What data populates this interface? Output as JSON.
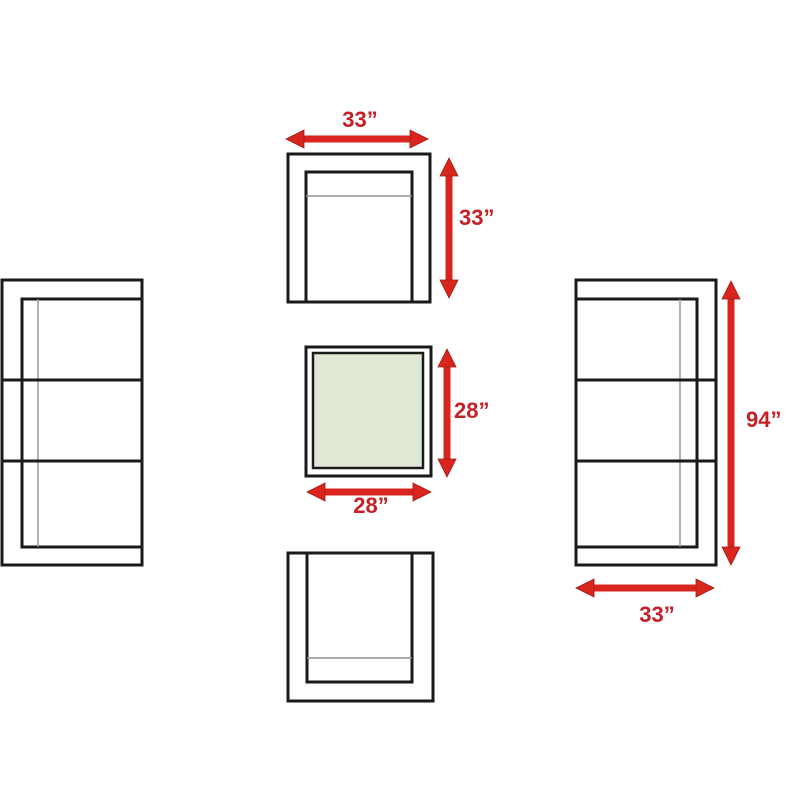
{
  "diagram": {
    "name": "patio-furniture-set-dimensions",
    "pieces": [
      {
        "id": "armchair-top",
        "kind": "armchair",
        "width_label": "33”",
        "depth_label": "33”"
      },
      {
        "id": "coffee-table",
        "kind": "square-table",
        "width_label": "28”",
        "depth_label": "28”"
      },
      {
        "id": "armchair-bottom",
        "kind": "armchair"
      },
      {
        "id": "sofa-left",
        "kind": "three-seat-sofa"
      },
      {
        "id": "sofa-right",
        "kind": "three-seat-sofa",
        "length_label": "94”",
        "depth_label": "33”"
      }
    ]
  },
  "labels": {
    "armchair_width": "33”",
    "armchair_depth": "33”",
    "table_depth": "28”",
    "table_width": "28”",
    "sofa_length": "94”",
    "sofa_depth": "33”"
  },
  "colors": {
    "background": "#ffffff",
    "outline": "#1a1a1a",
    "seam": "#909090",
    "arrow_fill": "#d9251d",
    "arrow_edge": "#9b1c17",
    "label_text": "#c42126",
    "table_top_fill": "#dfe8d4"
  }
}
